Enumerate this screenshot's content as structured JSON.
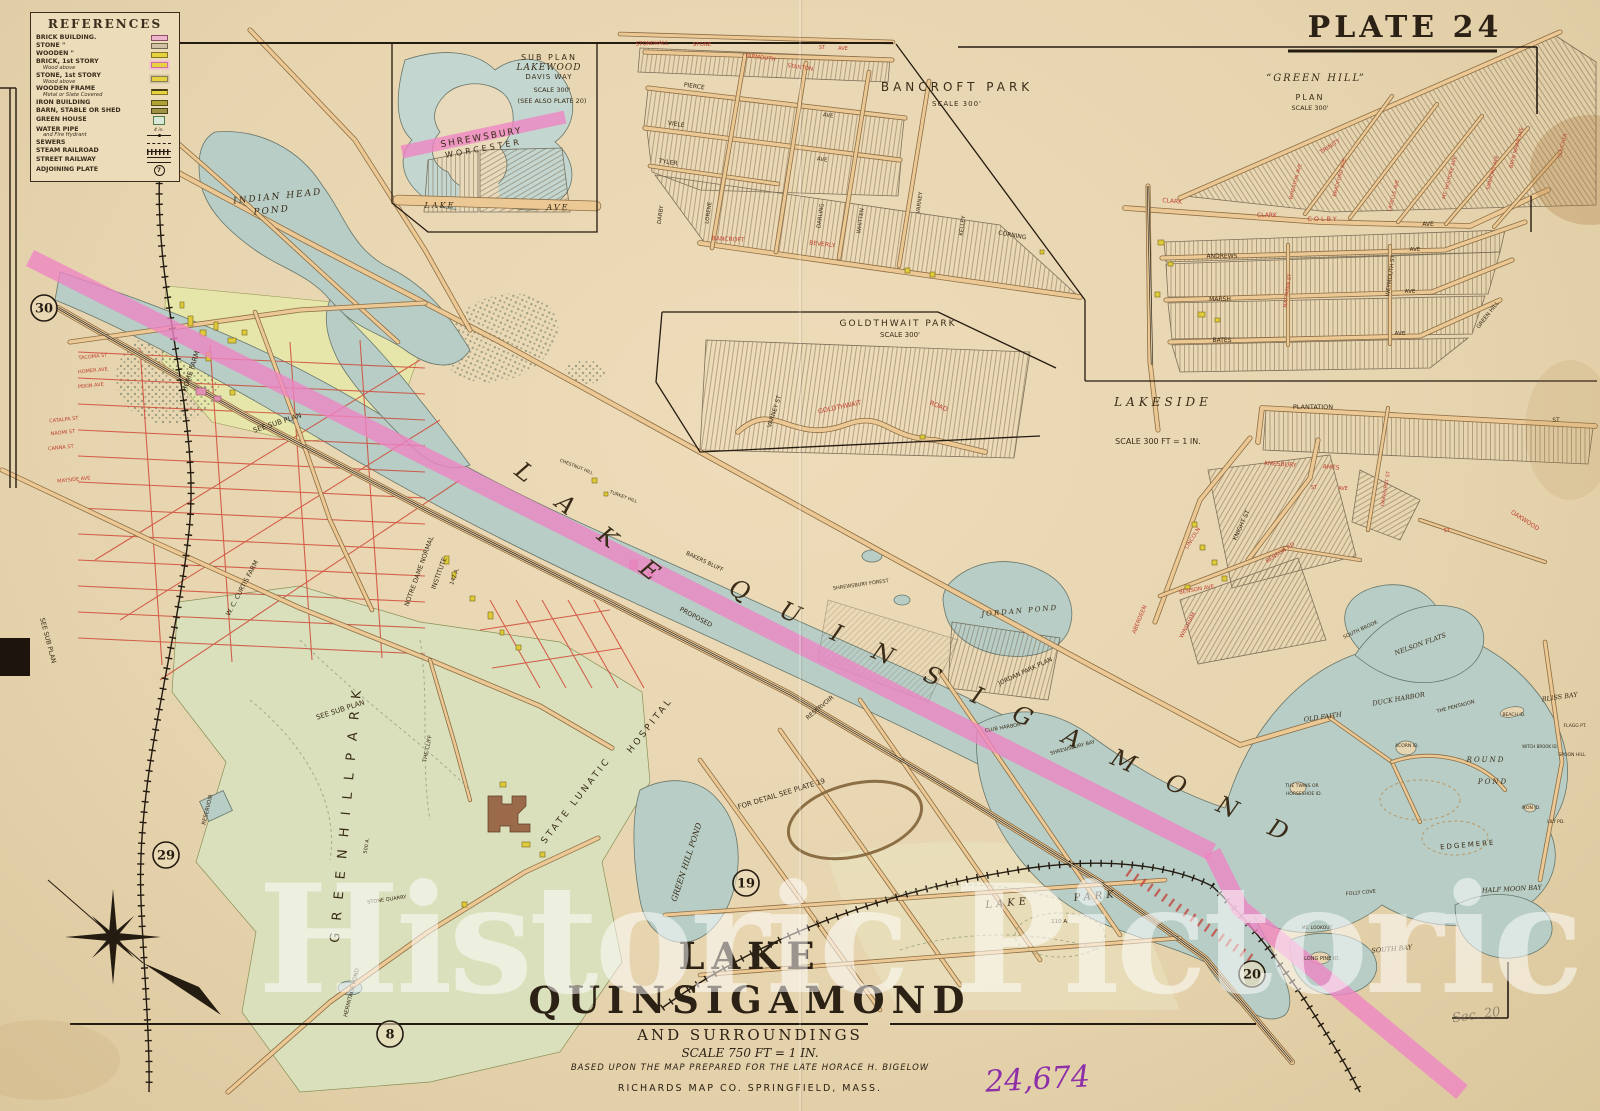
{
  "plate": {
    "title": "PLATE 24"
  },
  "legend": {
    "title": "REFERENCES",
    "items": [
      {
        "label": "BRICK BUILDING.",
        "swatch": "brick"
      },
      {
        "label": "STONE \"",
        "swatch": "stone"
      },
      {
        "label": "WOODEN \"",
        "swatch": "wood"
      },
      {
        "label": "BRICK, 1st STORY",
        "sub": "Wood above",
        "swatch": "brick1"
      },
      {
        "label": "STONE, 1st STORY",
        "sub": "Wood above",
        "swatch": "stone1"
      },
      {
        "label": "WOODEN FRAME",
        "sub": "Metal or Slate Covered",
        "swatch": "woodframe"
      },
      {
        "label": "IRON BUILDING",
        "swatch": "iron"
      },
      {
        "label": "BARN, STABLE OR SHED",
        "swatch": "barn"
      },
      {
        "label": "GREEN HOUSE",
        "swatch": "greenhouse"
      },
      {
        "label": "WATER PIPE",
        "sub": "and Fire Hydrant",
        "swatch": "waterpipe",
        "size_note": "4 in."
      },
      {
        "label": "SEWERS",
        "swatch": "sewer"
      },
      {
        "label": "STEAM RAILROAD",
        "swatch": "railroad"
      },
      {
        "label": "STREET RAILWAY",
        "swatch": "streetrail"
      },
      {
        "label": "ADJOINING PLATE",
        "swatch": "plate",
        "plate_number": "7"
      }
    ]
  },
  "title_block": {
    "title": "LAKE QUINSIGAMOND",
    "subtitle": "AND SURROUNDINGS",
    "scale": "SCALE 750 FT = 1 IN.",
    "credit": "BASED UPON THE MAP PREPARED FOR THE LATE HORACE H. BIGELOW",
    "publisher": "RICHARDS MAP CO.   SPRINGFIELD, MASS."
  },
  "watermark": {
    "text": "Historic Pictoric",
    "registered": "®"
  },
  "annotations": {
    "handwritten_number": "24,674",
    "pencil_note": "Sec. 20"
  },
  "plate_markers": [
    {
      "label": "30",
      "x": 44,
      "y": 308
    },
    {
      "label": "29",
      "x": 166,
      "y": 855
    },
    {
      "label": "8",
      "x": 390,
      "y": 1034
    },
    {
      "label": "19",
      "x": 746,
      "y": 883
    },
    {
      "label": "20",
      "x": 1252,
      "y": 974
    }
  ],
  "map_labels": [
    {
      "t": "SUB PLAN",
      "x": 549,
      "y": 60,
      "fs": 8,
      "ls": 2
    },
    {
      "t": "LAKEWOOD",
      "x": 549,
      "y": 70,
      "fs": 9,
      "ls": 1,
      "f": "si"
    },
    {
      "t": "DAVIS WAY",
      "x": 549,
      "y": 79,
      "fs": 7,
      "ls": 1
    },
    {
      "t": "SCALE 300'",
      "x": 552,
      "y": 92,
      "fs": 6.5
    },
    {
      "t": "(SEE ALSO PLATE 20)",
      "x": 552,
      "y": 103,
      "fs": 6.5
    },
    {
      "t": "SHREWSBURY",
      "x": 482,
      "y": 140,
      "fs": 9,
      "ls": 2,
      "rot": -10
    },
    {
      "t": "WORCESTER",
      "x": 484,
      "y": 151,
      "fs": 8,
      "ls": 3,
      "rot": -10
    },
    {
      "t": "LAKE",
      "x": 440,
      "y": 208,
      "fs": 8,
      "ls": 2,
      "f": "si"
    },
    {
      "t": "AVE",
      "x": 558,
      "y": 210,
      "fs": 8,
      "ls": 2,
      "f": "si"
    },
    {
      "t": "BANCROFT PARK",
      "x": 957,
      "y": 91,
      "fs": 12,
      "ls": 4
    },
    {
      "t": "SCALE 300'",
      "x": 957,
      "y": 106,
      "fs": 7,
      "ls": 1
    },
    {
      "t": "STONEHALL",
      "x": 652,
      "y": 45,
      "fs": 5.5,
      "c": "r",
      "rot": -2
    },
    {
      "t": "STONE",
      "x": 702,
      "y": 46,
      "fs": 5.5,
      "c": "r"
    },
    {
      "t": "ST",
      "x": 822,
      "y": 49,
      "fs": 5,
      "c": "r"
    },
    {
      "t": "AVE",
      "x": 843,
      "y": 50,
      "fs": 5,
      "c": "r"
    },
    {
      "t": "YARMOUTH",
      "x": 760,
      "y": 59,
      "fs": 5.5,
      "c": "r",
      "rot": 8
    },
    {
      "t": "STANTON",
      "x": 800,
      "y": 69,
      "fs": 5.5,
      "c": "r",
      "rot": 8
    },
    {
      "t": "PIERCE",
      "x": 694,
      "y": 88,
      "fs": 6,
      "rot": 8
    },
    {
      "t": "AVE",
      "x": 828,
      "y": 117,
      "fs": 5.5,
      "rot": 8
    },
    {
      "t": "VIELE",
      "x": 676,
      "y": 126,
      "fs": 6,
      "rot": 8
    },
    {
      "t": "AVE",
      "x": 822,
      "y": 161,
      "fs": 5.5,
      "rot": 8
    },
    {
      "t": "TYLER",
      "x": 668,
      "y": 164,
      "fs": 6,
      "rot": 8
    },
    {
      "t": "DARBY",
      "x": 662,
      "y": 215,
      "fs": 5.5,
      "rot": -82
    },
    {
      "t": "LORENE",
      "x": 710,
      "y": 213,
      "fs": 5.5,
      "rot": -82
    },
    {
      "t": "DARLING",
      "x": 822,
      "y": 216,
      "fs": 5.5,
      "rot": -82
    },
    {
      "t": "WHITTEN",
      "x": 862,
      "y": 221,
      "fs": 5.5,
      "rot": -82
    },
    {
      "t": "VARNEY",
      "x": 921,
      "y": 203,
      "fs": 5.5,
      "rot": -82
    },
    {
      "t": "KELLEY",
      "x": 964,
      "y": 226,
      "fs": 5.5,
      "rot": -82
    },
    {
      "t": "CORNING",
      "x": 1012,
      "y": 237,
      "fs": 6,
      "rot": 10
    },
    {
      "t": "BEVERLY",
      "x": 822,
      "y": 246,
      "fs": 6,
      "c": "r",
      "rot": 6
    },
    {
      "t": "BANCROFT",
      "x": 728,
      "y": 241,
      "fs": 6,
      "c": "r",
      "rot": 3
    },
    {
      "t": "GOLDTHWAIT PARK",
      "x": 898,
      "y": 326,
      "fs": 9,
      "ls": 2
    },
    {
      "t": "SCALE 300'",
      "x": 900,
      "y": 337,
      "fs": 7
    },
    {
      "t": "VARNEY ST",
      "x": 776,
      "y": 412,
      "fs": 6,
      "rot": -72
    },
    {
      "t": "GOLDTHWAIT",
      "x": 840,
      "y": 409,
      "fs": 6.5,
      "c": "r",
      "rot": -12
    },
    {
      "t": "ROAD",
      "x": 938,
      "y": 408,
      "fs": 6.5,
      "c": "r",
      "rot": 22
    },
    {
      "t": "“GREEN HILL”",
      "x": 1316,
      "y": 81,
      "fs": 10,
      "ls": 2,
      "f": "si"
    },
    {
      "t": "PLAN",
      "x": 1310,
      "y": 100,
      "fs": 8,
      "ls": 2
    },
    {
      "t": "SCALE 300'",
      "x": 1310,
      "y": 110,
      "fs": 6.5
    },
    {
      "t": "CLARK",
      "x": 1172,
      "y": 203,
      "fs": 6,
      "c": "r",
      "rot": 5
    },
    {
      "t": "CLARK",
      "x": 1267,
      "y": 217,
      "fs": 6,
      "c": "r"
    },
    {
      "t": "COLBY",
      "x": 1323,
      "y": 221,
      "fs": 6.5,
      "c": "r",
      "ls": 2
    },
    {
      "t": "AVE",
      "x": 1428,
      "y": 226,
      "fs": 6
    },
    {
      "t": "TRINITY",
      "x": 1331,
      "y": 148,
      "fs": 6,
      "c": "r",
      "rot": -33
    },
    {
      "t": "WHEATON AVE",
      "x": 1297,
      "y": 182,
      "fs": 5,
      "c": "r",
      "rot": -75
    },
    {
      "t": "BRADFORD AVE",
      "x": 1341,
      "y": 178,
      "fs": 5,
      "c": "r",
      "rot": -75
    },
    {
      "t": "LASELLE AVE",
      "x": 1395,
      "y": 196,
      "fs": 5,
      "c": "r",
      "rot": -75
    },
    {
      "t": "MT. HOLYOKE AVE",
      "x": 1451,
      "y": 178,
      "fs": 5,
      "c": "r",
      "rot": -75
    },
    {
      "t": "SIMMONS AVE",
      "x": 1494,
      "y": 173,
      "fs": 5,
      "c": "r",
      "rot": -75
    },
    {
      "t": "BRYN MAWR AVE",
      "x": 1518,
      "y": 148,
      "fs": 5,
      "c": "r",
      "rot": -75
    },
    {
      "t": "GOUCHER",
      "x": 1564,
      "y": 146,
      "fs": 5,
      "c": "r",
      "rot": -75
    },
    {
      "t": "ANDREWS",
      "x": 1222,
      "y": 258,
      "fs": 6
    },
    {
      "t": "AVE",
      "x": 1415,
      "y": 251,
      "fs": 5.5
    },
    {
      "t": "MARSH",
      "x": 1220,
      "y": 301,
      "fs": 6
    },
    {
      "t": "AVE",
      "x": 1410,
      "y": 293,
      "fs": 5.5
    },
    {
      "t": "BATES",
      "x": 1222,
      "y": 342,
      "fs": 6
    },
    {
      "t": "AVE",
      "x": 1400,
      "y": 335,
      "fs": 5.5
    },
    {
      "t": "WEYMOUTH ST",
      "x": 1392,
      "y": 276,
      "fs": 5.5,
      "rot": -82
    },
    {
      "t": "MATTAPAN ST",
      "x": 1289,
      "y": 291,
      "fs": 5,
      "c": "r",
      "rot": -82
    },
    {
      "t": "GREEN HILL",
      "x": 1489,
      "y": 316,
      "fs": 5.5,
      "rot": -52
    },
    {
      "t": "LAKESIDE",
      "x": 1163,
      "y": 406,
      "fs": 12,
      "ls": 4,
      "f": "si"
    },
    {
      "t": "SCALE 300 FT = 1 IN.",
      "x": 1158,
      "y": 444,
      "fs": 8
    },
    {
      "t": "PLANTATION",
      "x": 1313,
      "y": 409,
      "fs": 6.5
    },
    {
      "t": "ST",
      "x": 1556,
      "y": 422,
      "fs": 6
    },
    {
      "t": "AMESBURY",
      "x": 1280,
      "y": 466,
      "fs": 6,
      "c": "r",
      "rot": 4
    },
    {
      "t": "AMES",
      "x": 1331,
      "y": 469,
      "fs": 6,
      "c": "r",
      "rot": 4
    },
    {
      "t": "ST",
      "x": 1314,
      "y": 489,
      "fs": 5,
      "c": "r"
    },
    {
      "t": "AVE",
      "x": 1343,
      "y": 490,
      "fs": 5,
      "c": "r"
    },
    {
      "t": "KNIGHT ST",
      "x": 1243,
      "y": 526,
      "fs": 6,
      "rot": -65
    },
    {
      "t": "LINCOLN",
      "x": 1194,
      "y": 539,
      "fs": 5.5,
      "c": "r",
      "rot": -58
    },
    {
      "t": "OAKHURST ST",
      "x": 1387,
      "y": 489,
      "fs": 5,
      "c": "r",
      "rot": -80
    },
    {
      "t": "BENSON AVE",
      "x": 1197,
      "y": 591,
      "fs": 5.5,
      "c": "r",
      "rot": -10
    },
    {
      "t": "BENSON RD",
      "x": 1281,
      "y": 554,
      "fs": 5.5,
      "c": "r",
      "rot": -33
    },
    {
      "t": "OAKWOOD",
      "x": 1524,
      "y": 522,
      "fs": 6,
      "c": "r",
      "rot": 33
    },
    {
      "t": "ST",
      "x": 1447,
      "y": 532,
      "fs": 5.5,
      "c": "r"
    },
    {
      "t": "WINDHAM",
      "x": 1189,
      "y": 626,
      "fs": 5.5,
      "c": "r",
      "rot": -62
    },
    {
      "t": "ABERDEEN",
      "x": 1141,
      "y": 620,
      "fs": 5.5,
      "c": "r",
      "rot": -68
    },
    {
      "t": "INDIAN HEAD",
      "x": 278,
      "y": 199,
      "fs": 9,
      "f": "si",
      "ls": 2,
      "rot": -6
    },
    {
      "t": "POND",
      "x": 272,
      "y": 213,
      "fs": 9,
      "f": "si",
      "ls": 2,
      "rot": -6
    },
    {
      "t": "HOME FARM",
      "x": 193,
      "y": 372,
      "fs": 7,
      "rot": -72
    },
    {
      "t": "SEE SUB PLAN",
      "x": 278,
      "y": 425,
      "fs": 7,
      "rot": -18
    },
    {
      "t": "SEE SUB PLAN",
      "x": 341,
      "y": 712,
      "fs": 7,
      "rot": -18
    },
    {
      "t": "SEE SUB PLAN",
      "x": 46,
      "y": 641,
      "fs": 6.5,
      "rot": 75
    },
    {
      "t": "W. C. CURTIS FARM",
      "x": 244,
      "y": 589,
      "fs": 6.5,
      "rot": -62
    },
    {
      "t": "NOTRE DAME NORMAL",
      "x": 421,
      "y": 572,
      "fs": 6.5,
      "rot": -70
    },
    {
      "t": "INSTITUTE",
      "x": 441,
      "y": 574,
      "fs": 6.5,
      "rot": -70
    },
    {
      "t": "147 A.",
      "x": 456,
      "y": 577,
      "fs": 5.5,
      "rot": -70
    },
    {
      "t": "STATE LUNATIC",
      "x": 578,
      "y": 802,
      "fs": 9,
      "ls": 3,
      "rot": -52
    },
    {
      "t": "HOSPITAL",
      "x": 652,
      "y": 727,
      "fs": 9,
      "ls": 3,
      "rot": -52
    },
    {
      "t": "THE CLIFF",
      "x": 429,
      "y": 749,
      "fs": 5.5,
      "rot": -78
    },
    {
      "t": "GREEN HILL POND",
      "x": 689,
      "y": 863,
      "fs": 8,
      "f": "si",
      "rot": -72
    },
    {
      "t": "G R E E N   H I L L   P A R K",
      "x": 350,
      "y": 815,
      "fs": 13,
      "ls": 4,
      "rot": -85
    },
    {
      "t": "500 A.",
      "x": 368,
      "y": 846,
      "fs": 5,
      "rot": -80
    },
    {
      "t": "STONE QUARRY",
      "x": 387,
      "y": 901,
      "fs": 5,
      "rot": -8
    },
    {
      "t": "RESERVOIR",
      "x": 209,
      "y": 810,
      "fs": 5.5,
      "rot": -76
    },
    {
      "t": "HERMITAGE POND",
      "x": 353,
      "y": 993,
      "fs": 5.5,
      "rot": -76
    },
    {
      "t": "FOR DETAIL SEE PLATE 19",
      "x": 782,
      "y": 796,
      "fs": 7,
      "rot": -17
    },
    {
      "t": "RESERVOIR",
      "x": 821,
      "y": 709,
      "fs": 6,
      "rot": -40
    },
    {
      "t": "PROPOSED",
      "x": 695,
      "y": 619,
      "fs": 6.5,
      "rot": 28
    },
    {
      "t": "BAKERS BLUFF",
      "x": 704,
      "y": 563,
      "fs": 5.5,
      "rot": 25
    },
    {
      "t": "TURKEY HILL",
      "x": 623,
      "y": 498,
      "fs": 4.5,
      "rot": 20
    },
    {
      "t": "CHESTNUT HILL",
      "x": 576,
      "y": 468,
      "fs": 4.5,
      "rot": 22
    },
    {
      "t": "SHREWSBURY FOREST",
      "x": 861,
      "y": 586,
      "fs": 5,
      "rot": -8
    },
    {
      "t": "JORDAN POND",
      "x": 1020,
      "y": 613,
      "fs": 7,
      "f": "si",
      "ls": 2,
      "rot": -5
    },
    {
      "t": "JORDAN PARK PLAN",
      "x": 1026,
      "y": 673,
      "fs": 6,
      "rot": -25
    },
    {
      "t": "CLUB HARBOR",
      "x": 1003,
      "y": 729,
      "fs": 5,
      "rot": -10
    },
    {
      "t": "SHREWSBURY BAY",
      "x": 1073,
      "y": 749,
      "fs": 5,
      "rot": -15
    },
    {
      "t": "NELSON FLATS",
      "x": 1421,
      "y": 646,
      "fs": 6.5,
      "f": "si",
      "rot": -20
    },
    {
      "t": "DUCK HARBOR",
      "x": 1399,
      "y": 701,
      "fs": 6.5,
      "f": "si",
      "rot": -10
    },
    {
      "t": "THE PENTAGON",
      "x": 1456,
      "y": 708,
      "fs": 5,
      "rot": -15
    },
    {
      "t": "OLD FAITH",
      "x": 1323,
      "y": 719,
      "fs": 6.5,
      "f": "si",
      "rot": -8
    },
    {
      "t": "BLISS BAY",
      "x": 1560,
      "y": 699,
      "fs": 6.5,
      "f": "si",
      "rot": -8
    },
    {
      "t": "BEACH ID.",
      "x": 1514,
      "y": 716,
      "fs": 4.5
    },
    {
      "t": "ACORN ID.",
      "x": 1407,
      "y": 747,
      "fs": 4.5
    },
    {
      "t": "ROUND",
      "x": 1486,
      "y": 762,
      "fs": 7,
      "f": "si",
      "ls": 2
    },
    {
      "t": "POND",
      "x": 1493,
      "y": 784,
      "fs": 7,
      "f": "si",
      "ls": 2
    },
    {
      "t": "WITCH BROOK ID.",
      "x": 1540,
      "y": 748,
      "fs": 4
    },
    {
      "t": "SPOON HILL",
      "x": 1572,
      "y": 756,
      "fs": 4.5
    },
    {
      "t": "FLAGG PT.",
      "x": 1575,
      "y": 727,
      "fs": 4.5
    },
    {
      "t": "THE TWINS OR",
      "x": 1302,
      "y": 787,
      "fs": 4.5
    },
    {
      "t": "HORSESHOE ID.",
      "x": 1304,
      "y": 795,
      "fs": 4.5
    },
    {
      "t": "IRON ID.",
      "x": 1531,
      "y": 809,
      "fs": 4.5
    },
    {
      "t": "LILY PD.",
      "x": 1556,
      "y": 823,
      "fs": 4.5
    },
    {
      "t": "EDGEMERE",
      "x": 1468,
      "y": 847,
      "fs": 7,
      "ls": 2,
      "rot": -5
    },
    {
      "t": "HALF MOON BAY",
      "x": 1512,
      "y": 891,
      "fs": 6.5,
      "f": "si",
      "rot": -3
    },
    {
      "t": "SOUTH BAY",
      "x": 1392,
      "y": 951,
      "fs": 6.5,
      "f": "si",
      "rot": -5
    },
    {
      "t": "FOLLY COVE",
      "x": 1361,
      "y": 894,
      "fs": 5,
      "rot": -5
    },
    {
      "t": "LONG PINE ID.",
      "x": 1322,
      "y": 960,
      "fs": 5
    },
    {
      "t": "MT. LOOKOUT",
      "x": 1317,
      "y": 929,
      "fs": 4.5
    },
    {
      "t": "SOUTH BROOK",
      "x": 1361,
      "y": 631,
      "fs": 5,
      "rot": -25
    },
    {
      "t": "LAKE",
      "x": 1008,
      "y": 906,
      "fs": 10,
      "f": "si",
      "ls": 4,
      "rot": -5
    },
    {
      "t": "PARK",
      "x": 1096,
      "y": 899,
      "fs": 10,
      "f": "si",
      "ls": 4,
      "rot": -5
    },
    {
      "t": "110 A.",
      "x": 1060,
      "y": 923,
      "fs": 5.5
    },
    {
      "t": "L A K E",
      "x": 588,
      "y": 532,
      "fs": 24,
      "f": "si",
      "ls": 14,
      "rot": 38
    },
    {
      "t": "Q U I N S I G A M O N D",
      "x": 1012,
      "y": 720,
      "fs": 24,
      "f": "si",
      "ls": 14,
      "rot": 24
    },
    {
      "t": "TACOMA ST",
      "x": 93,
      "y": 358,
      "fs": 5,
      "c": "r",
      "rot": -6
    },
    {
      "t": "HOMER AVE",
      "x": 93,
      "y": 372,
      "fs": 5,
      "c": "r",
      "rot": -6
    },
    {
      "t": "PEKIN AVE",
      "x": 91,
      "y": 387,
      "fs": 5,
      "c": "r",
      "rot": -6
    },
    {
      "t": "CATALPA ST",
      "x": 64,
      "y": 421,
      "fs": 5,
      "c": "r",
      "rot": -6
    },
    {
      "t": "NAOMI ST",
      "x": 63,
      "y": 434,
      "fs": 5,
      "c": "r",
      "rot": -6
    },
    {
      "t": "CANNA ST",
      "x": 61,
      "y": 449,
      "fs": 5,
      "c": "r",
      "rot": -6
    },
    {
      "t": "MAYSIDE AVE",
      "x": 74,
      "y": 481,
      "fs": 5,
      "c": "r",
      "rot": -6
    }
  ]
}
